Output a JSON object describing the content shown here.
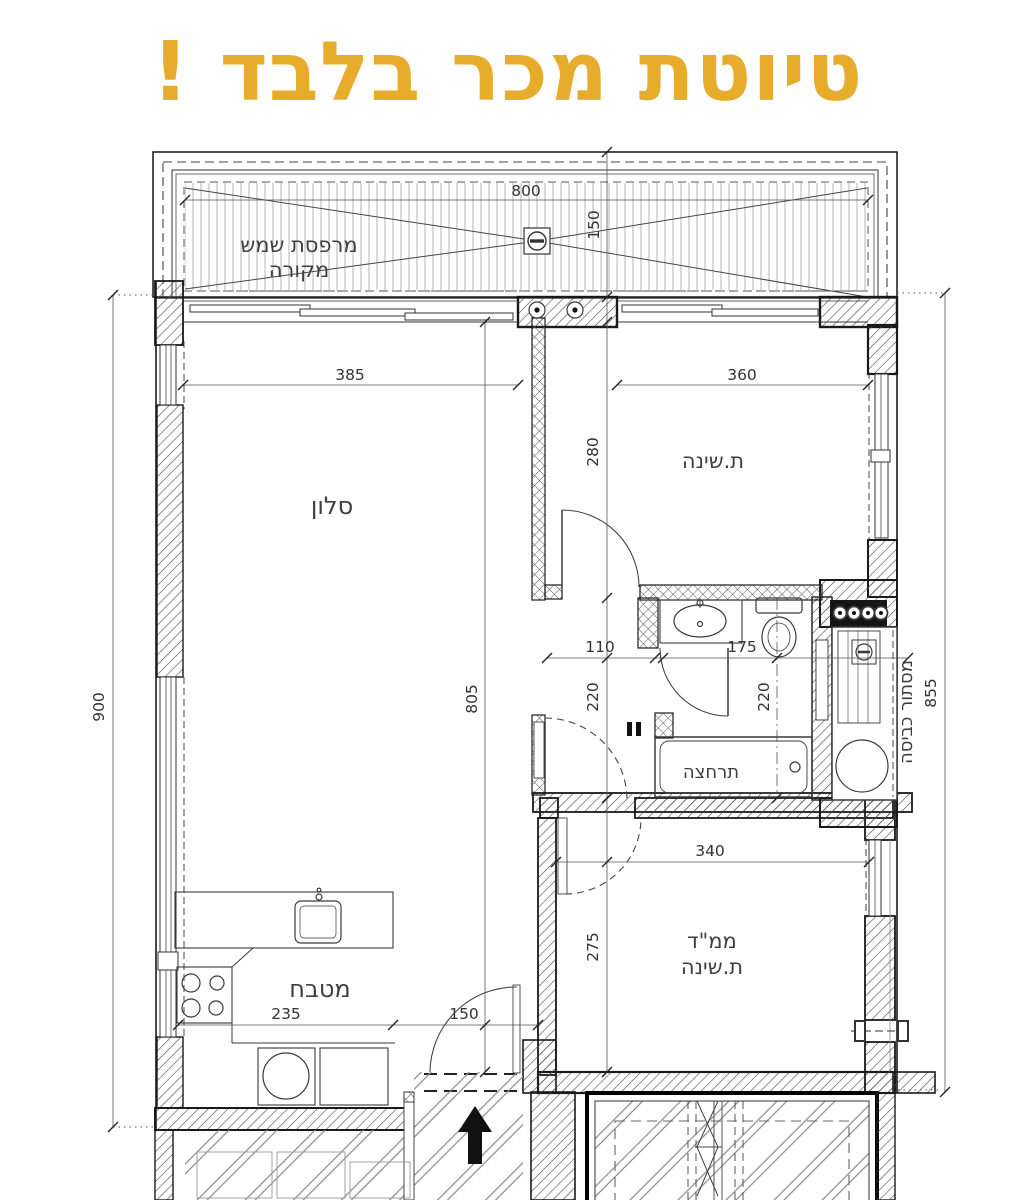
{
  "title": {
    "text": "טיוטת מכר בלבד !",
    "color": "#E8AC2C"
  },
  "plan": {
    "rooms": {
      "balcony_line1": "מרפסת שמש",
      "balcony_line2": "מקורה",
      "living": "סלון",
      "bedroom": "ת.שינה",
      "bathroom": "תרחצה",
      "safe_room_line1": "ממ\"ד",
      "safe_room_line2": "ת.שינה",
      "kitchen": "מטבח",
      "laundry": "מסתור כביסה"
    },
    "dimensions": {
      "balcony_width": "800",
      "balcony_depth": "150",
      "living_width": "385",
      "bedroom_width": "360",
      "bedroom_depth": "280",
      "left_total": "900",
      "living_kitchen_length": "805",
      "hall_width": "110",
      "bath_width": "175",
      "hall_depth": "220",
      "bath_depth": "220",
      "right_total": "855",
      "safe_room_width": "340",
      "safe_room_depth": "275",
      "kitchen_width": "235",
      "entry_width": "150"
    },
    "colors": {
      "line": "#2b2b2b",
      "dim_text": "#333333",
      "wall_hatch": "#4a4a4a",
      "balcony_stripe": "#aaaaaa",
      "title": "#E8AC2C"
    }
  }
}
